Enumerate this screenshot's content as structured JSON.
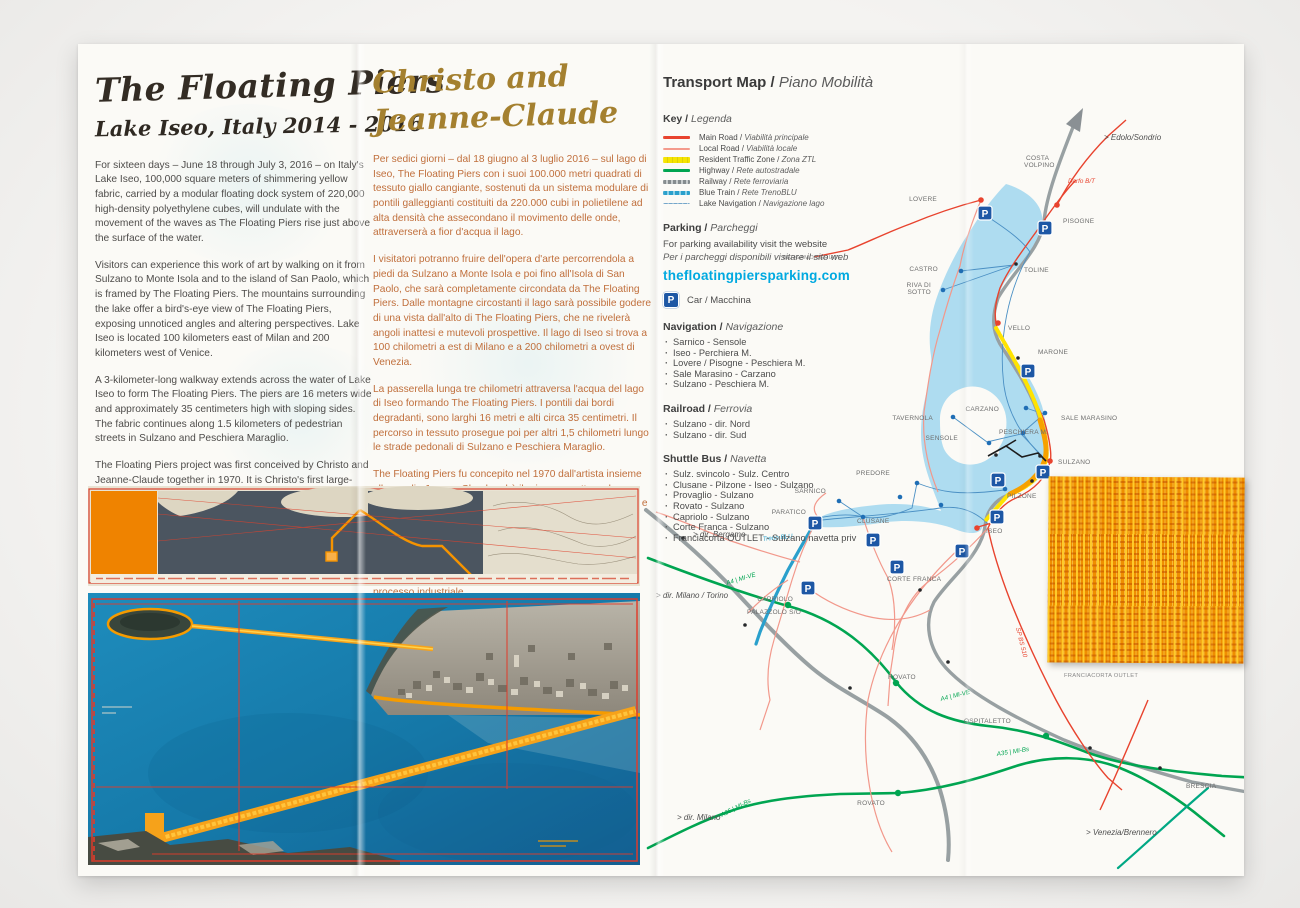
{
  "left_panel": {
    "title": "The Floating Piers",
    "subtitle": "Lake Iseo, Italy 2014 - 2016",
    "paragraphs": [
      "For sixteen days – June 18 through July 3, 2016 – on Italy's Lake Iseo, 100,000 square meters of shimmering yellow fabric, carried by a modular floating dock system of 220,000 high-density polyethylene cubes, will undulate with the movement of the waves as The Floating Piers rise just above the surface of the water.",
      "Visitors can experience this work of art by walking on it from Sulzano to Monte Isola and to the island of San Paolo, which is framed by The Floating Piers. The mountains surrounding the lake offer a bird's-eye view of The Floating Piers, exposing unnoticed angles and altering perspectives. Lake Iseo is located 100 kilometers east of Milan and 200 kilometers west of Venice.",
      "A 3-kilometer-long walkway extends across the water of Lake Iseo to form The Floating Piers. The piers are 16 meters wide and approximately 35 centimeters high with sloping sides. The fabric continues along 1.5 kilometers of pedestrian streets in Sulzano and Peschiera Maraglio.",
      "The Floating Piers project was first conceived by Christo and Jeanne-Claude together in 1970. It is Christo's first large-scale project since Christo and Jeanne-Claude realized The Gates in 2005, and since Jeanne-Claude passed away in 2009. As with all of Christo and Jeanne-Claude's projects, The Floating Piers is funded entirely through the sale of Christo's original works of art. After the 16-day-exhibition, all components will be removed and industrially recycled."
    ]
  },
  "middle_panel": {
    "title_line1": "Christo and",
    "title_line2": "Jeanne-Claude",
    "paragraphs": [
      "Per sedici giorni – dal 18 giugno al 3 luglio 2016 – sul lago di Iseo, The Floating Piers con i suoi 100.000 metri quadrati di tessuto giallo cangiante, sostenuti da un sistema modulare di pontili galleggianti costituiti da 220.000 cubi in polietilene ad alta densità che assecondano il movimento delle onde, attraverserà a fior d'acqua il lago.",
      "I visitatori potranno fruire dell'opera d'arte percorrendola a piedi da Sulzano a Monte Isola e poi fino all'Isola di San Paolo, che sarà completamente circondata da The Floating Piers. Dalle montagne circostanti il lago sarà possibile godere di una vista dall'alto di The Floating Piers, che ne rivelerà angoli inattesi e mutevoli prospettive. Il lago di Iseo si trova a 100 chilometri a est di Milano e a 200 chilometri a ovest di Venezia.",
      "La passerella lunga tre chilometri attraversa l'acqua del lago di Iseo formando The Floating Piers. I pontili dai bordi degradanti, sono larghi 16 metri e alti circa 35 centimetri. Il percorso in tessuto prosegue poi per altri 1,5 chilometri lungo le strade pedonali di Sulzano e Peschiera Maraglio.",
      "The Floating Piers fu concepito nel 1970 dall'artista insieme alla moglie Jeanne-Claude ed è il primo progetto su larga scala da quando realizzarono insieme The Gates nel 2005, e dalla scomparsa di Jeanne-Claude nel 2009. Come tutti i progetti di Christo e Jeanne-Claude, The Floating Piers è interamente finanziato con la vendita degli originali delle opere di Christo. Al termine dei 16 giorni di apertura al pubblico, tutto sarà smontato e riciclato attraverso un processo industriale."
    ]
  },
  "transport": {
    "title_en": "Transport Map / ",
    "title_it": "Piano Mobilità",
    "key_en": "Key / ",
    "key_it": "Legenda",
    "legend": [
      {
        "en": "Main Road / ",
        "it": "Viabilità principale",
        "color": "#e8432e"
      },
      {
        "en": "Local Road / ",
        "it": "Viabilità locale",
        "color": "#f49a8c"
      },
      {
        "en": "Resident Traffic Zone / ",
        "it": "Zona ZTL",
        "color": "#f6e400"
      },
      {
        "en": "Highway / ",
        "it": "Rete autostradale",
        "color": "#00a551"
      },
      {
        "en": "Railway / ",
        "it": "Rete ferroviaria",
        "color": "#848b8e"
      },
      {
        "en": "Blue Train / ",
        "it": "Rete TrenoBLU",
        "color": "#2aa0cc"
      },
      {
        "en": "Lake Navigation / ",
        "it": "Navigazione lago",
        "color": "#74a6ca"
      }
    ],
    "parking_en": "Parking / ",
    "parking_it": "Parcheggi",
    "parking_line1": "For parking availability visit the website",
    "parking_line2": "Per i parcheggi disponibili visitare il sito web",
    "website": "thefloatingpiersparking.com",
    "p_letter": "P",
    "car_label": "Car / Macchina",
    "navigation_en": "Navigation / ",
    "navigation_it": "Navigazione",
    "navigation_items": [
      "Sarnico - Sensole",
      "Iseo - Perchiera M.",
      "Lovere / Pisogne - Peschiera M.",
      "Sale Marasino - Carzano",
      "Sulzano - Peschiera M."
    ],
    "railroad_en": "Railroad / ",
    "railroad_it": "Ferrovia",
    "railroad_items": [
      "Sulzano - dir. Nord",
      "Sulzano - dir. Sud"
    ],
    "shuttle_en": "Shuttle Bus / ",
    "shuttle_it": "Navetta",
    "shuttle_items": [
      "Sulz. svincolo - Sulz. Centro",
      "Clusane - Pilzone - Iseo - Sulzano",
      "Provaglio - Sulzano",
      "Rovato - Sulzano",
      "Capriolo - Sulzano",
      "Corte Franca - Sulzano",
      "Franciacorta OUTLET - Sulzano navetta priv"
    ]
  },
  "map": {
    "colors": {
      "water": "#aedcf0",
      "main_road": "#e8432e",
      "local_road": "#f2988b",
      "highway": "#00a551",
      "railway": "#98a0a2",
      "blue_train": "#2aa0cc",
      "ztl": "#ffe300",
      "piers_orange": "#f7a100",
      "parking": "#1d57a5"
    },
    "labels": [
      {
        "t": "COSTA",
        "x": 1026,
        "y": 160
      },
      {
        "t": "VOLPINO",
        "x": 1024,
        "y": 167
      },
      {
        "t": "LOVERE",
        "x": 937,
        "y": 201,
        "a": "end"
      },
      {
        "t": "PISOGNE",
        "x": 1063,
        "y": 223
      },
      {
        "t": "CASTRO",
        "x": 938,
        "y": 271,
        "a": "end"
      },
      {
        "t": "RIVA DI",
        "x": 931,
        "y": 287,
        "a": "end"
      },
      {
        "t": "SOTTO",
        "x": 931,
        "y": 294,
        "a": "end"
      },
      {
        "t": "TOLINE",
        "x": 1024,
        "y": 272
      },
      {
        "t": "VELLO",
        "x": 1008,
        "y": 330
      },
      {
        "t": "MARONE",
        "x": 1038,
        "y": 354
      },
      {
        "t": "SALE MARASINO",
        "x": 1061,
        "y": 420
      },
      {
        "t": "CARZANO",
        "x": 999,
        "y": 411,
        "a": "end"
      },
      {
        "t": "TAVERNOLA",
        "x": 933,
        "y": 420,
        "a": "end"
      },
      {
        "t": "PESCHIERA M.",
        "x": 999,
        "y": 434
      },
      {
        "t": "SENSOLE",
        "x": 958,
        "y": 440,
        "a": "end"
      },
      {
        "t": "SULZANO",
        "x": 1058,
        "y": 464
      },
      {
        "t": "PILZONE",
        "x": 1007,
        "y": 498
      },
      {
        "t": "ISEO",
        "x": 986,
        "y": 533
      },
      {
        "t": "PREDORE",
        "x": 890,
        "y": 475,
        "a": "end"
      },
      {
        "t": "SARNICO",
        "x": 826,
        "y": 493,
        "a": "end"
      },
      {
        "t": "PARATICO",
        "x": 806,
        "y": 514,
        "a": "end"
      },
      {
        "t": "CLUSANE",
        "x": 857,
        "y": 523
      },
      {
        "t": "CORTE FRANCA",
        "x": 887,
        "y": 581
      },
      {
        "t": "CAPRIOLO",
        "x": 793,
        "y": 601,
        "a": "end"
      },
      {
        "t": "PALAZZOLO S/O",
        "x": 747,
        "y": 614
      },
      {
        "t": "ROVATO",
        "x": 888,
        "y": 679
      },
      {
        "t": "OSPITALETTO",
        "x": 964,
        "y": 723
      },
      {
        "t": "ROVATO",
        "x": 885,
        "y": 805,
        "a": "end"
      },
      {
        "t": "FRANCIACORTA OUTLET",
        "x": 1064,
        "y": 677
      },
      {
        "t": "BRESCIA",
        "x": 1186,
        "y": 788
      },
      {
        "t": "BERGAMO/SERIATE",
        "x": 842,
        "y": 259,
        "a": "end"
      }
    ],
    "dirs": [
      {
        "t": "> Edolo/Sondrio",
        "x": 1104,
        "y": 140
      },
      {
        "t": "> dir. Bergamo",
        "x": 693,
        "y": 537
      },
      {
        "t": "> dir. Milano / Torino",
        "x": 656,
        "y": 598
      },
      {
        "t": "> dir. Milano",
        "x": 677,
        "y": 820
      },
      {
        "t": "> Venezia/Brennero",
        "x": 1086,
        "y": 835
      }
    ],
    "roads": [
      {
        "t": "Darfo B/T",
        "x": 1068,
        "y": 183,
        "c": "#e8432e",
        "r": 0
      },
      {
        "t": "SP BS 510",
        "x": 1016,
        "y": 628,
        "c": "#e8432e",
        "r": 76
      },
      {
        "t": "Treno BLU",
        "x": 763,
        "y": 541,
        "c": "#2aa0cc",
        "r": -6
      },
      {
        "t": "A4 | MI-VE",
        "x": 727,
        "y": 585,
        "c": "#00a551",
        "r": -17
      },
      {
        "t": "A4 | MI-VE",
        "x": 941,
        "y": 701,
        "c": "#00a551",
        "r": -14
      },
      {
        "t": "A35 | MI-Bs",
        "x": 997,
        "y": 756,
        "c": "#00a551",
        "r": -9
      },
      {
        "t": "A35 | MI-Bs",
        "x": 722,
        "y": 817,
        "c": "#00a551",
        "r": -27
      }
    ],
    "parkings": [
      [
        985,
        213
      ],
      [
        1045,
        228
      ],
      [
        1028,
        371
      ],
      [
        1043,
        472
      ],
      [
        998,
        480
      ],
      [
        997,
        517
      ],
      [
        962,
        551
      ],
      [
        873,
        540
      ],
      [
        897,
        567
      ],
      [
        815,
        523
      ],
      [
        808,
        588
      ]
    ],
    "dots": {
      "red": [
        [
          981,
          200
        ],
        [
          1057,
          205
        ],
        [
          1050,
          461
        ],
        [
          977,
          528
        ],
        [
          998,
          323
        ]
      ],
      "blue": [
        [
          961,
          271
        ],
        [
          943,
          290
        ],
        [
          1045,
          413
        ],
        [
          1026,
          408
        ],
        [
          953,
          417
        ],
        [
          989,
          443
        ],
        [
          1023,
          433
        ],
        [
          917,
          483
        ],
        [
          839,
          501
        ],
        [
          818,
          518
        ],
        [
          863,
          517
        ],
        [
          1005,
          489
        ],
        [
          900,
          497
        ],
        [
          941,
          505
        ]
      ],
      "green": [
        [
          788,
          605
        ],
        [
          896,
          683
        ],
        [
          898,
          793
        ],
        [
          1046,
          736
        ]
      ],
      "black": [
        [
          1016,
          264
        ],
        [
          1018,
          358
        ],
        [
          1032,
          481
        ],
        [
          996,
          455
        ],
        [
          1040,
          456
        ],
        [
          920,
          590
        ],
        [
          948,
          662
        ],
        [
          1090,
          748
        ],
        [
          683,
          538
        ],
        [
          745,
          625
        ],
        [
          850,
          688
        ],
        [
          1160,
          768
        ]
      ]
    }
  }
}
